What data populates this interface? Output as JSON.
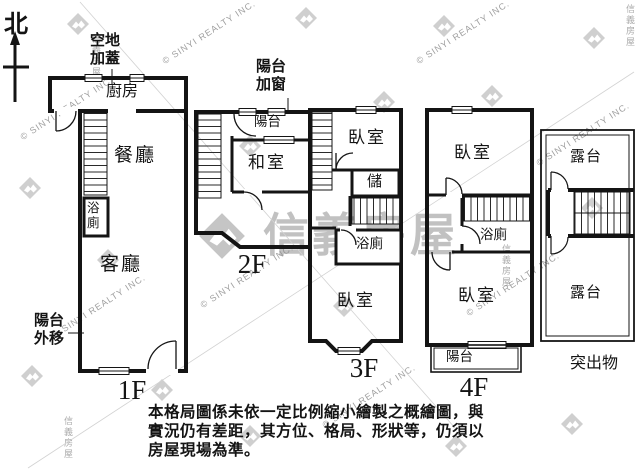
{
  "north_label": "北",
  "watermark": {
    "brand": "信義房屋",
    "copyright": "© SINYI REALTY INC."
  },
  "annotations": {
    "vacant_land_addition": "空地\n加蓋",
    "balcony_added_window": "陽台\n加窗",
    "balcony_extended": "陽台\n外移"
  },
  "floors": {
    "f1": {
      "label": "1F",
      "kitchen": "廚房",
      "dining_room": "餐廳",
      "bathroom": "浴廁",
      "living_room": "客廳"
    },
    "f2": {
      "label": "2F",
      "balcony": "陽台",
      "tatami_room": "和室"
    },
    "f3": {
      "label": "3F",
      "bedroom_top": "臥室",
      "storage": "儲",
      "bathroom": "浴廁",
      "bedroom_bottom": "臥室"
    },
    "f4": {
      "label": "4F",
      "bedroom_top": "臥室",
      "bathroom": "浴廁",
      "bedroom_bottom": "臥室",
      "balcony": "陽台"
    },
    "roof": {
      "label": "突出物",
      "terrace_top": "露台",
      "terrace_bottom": "露台"
    }
  },
  "disclaimer": "本格局圖係未依一定比例縮小繪製之概繪圖，與\n實況仍有差距，其方位、格局、形狀等，仍須以\n房屋現場為準。"
}
